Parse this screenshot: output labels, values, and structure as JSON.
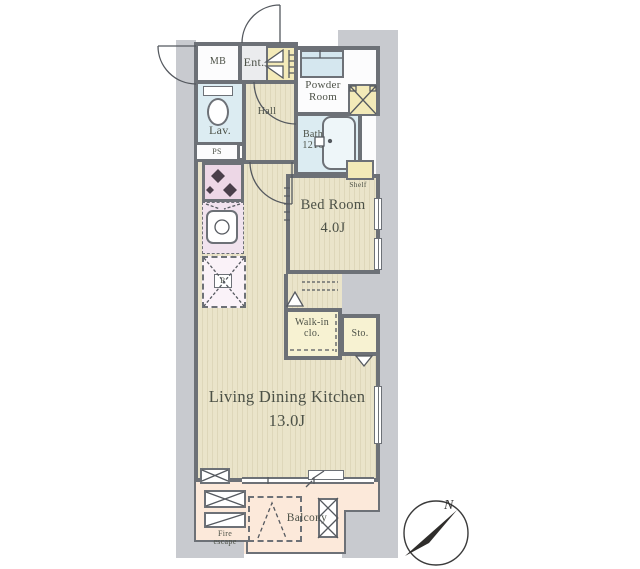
{
  "rooms": {
    "mb": {
      "label": "MB"
    },
    "ent": {
      "label": "Ent."
    },
    "powder_room": {
      "line1": "Powder",
      "line2": "Room"
    },
    "lav": {
      "label": "Lav."
    },
    "ps": {
      "label": "PS"
    },
    "hall": {
      "label": "Hall"
    },
    "bath": {
      "line1": "Bath",
      "line2": "1216"
    },
    "shelf": {
      "label": "Shelf"
    },
    "bed_room": {
      "name": "Bed Room",
      "size": "4.0J"
    },
    "walk_in_closet": {
      "line1": "Walk-in",
      "line2": "clo."
    },
    "storage": {
      "label": "Sto."
    },
    "ldk": {
      "name": "Living Dining Kitchen",
      "size": "13.0J"
    },
    "refrigerator": {
      "label": "R"
    },
    "balcony": {
      "label": "Balcony"
    },
    "fire_escape": {
      "line1": "Fire",
      "line2": "escape"
    }
  },
  "compass": {
    "label": "N"
  },
  "colors": {
    "wall": "#6d7177",
    "exterior": "#c8cacf",
    "flooring": "#e9e3c9",
    "water_rooms": "#dcecf2",
    "cabinets": "#f3eab8",
    "closet": "#f7f2d2",
    "kitchen_counter": "#edd7e6",
    "balcony": "#fce9da"
  }
}
